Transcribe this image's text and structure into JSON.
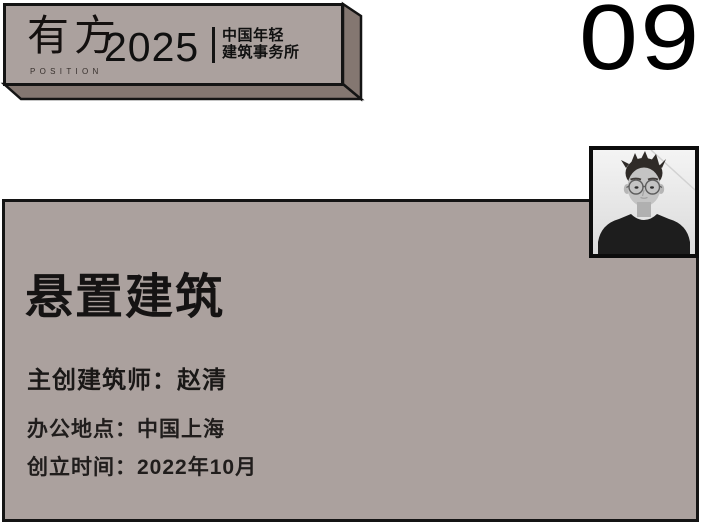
{
  "banner": {
    "logo_primary": "有方",
    "logo_secondary": "POSITION",
    "year": "2025",
    "subtitle_line1": "中国年轻",
    "subtitle_line2": "建筑事务所"
  },
  "index_number": "09",
  "card": {
    "studio_name": "悬置建筑",
    "rows": [
      {
        "label": "主创建筑师：",
        "value": "赵清"
      },
      {
        "label": "办公地点：",
        "value": "中国上海"
      },
      {
        "label": "创立时间：",
        "value": "2022年10月"
      }
    ]
  },
  "colors": {
    "panel": "#aba19e",
    "panel_dark": "#847771",
    "border": "#141414",
    "text": "#1b1b1b"
  }
}
